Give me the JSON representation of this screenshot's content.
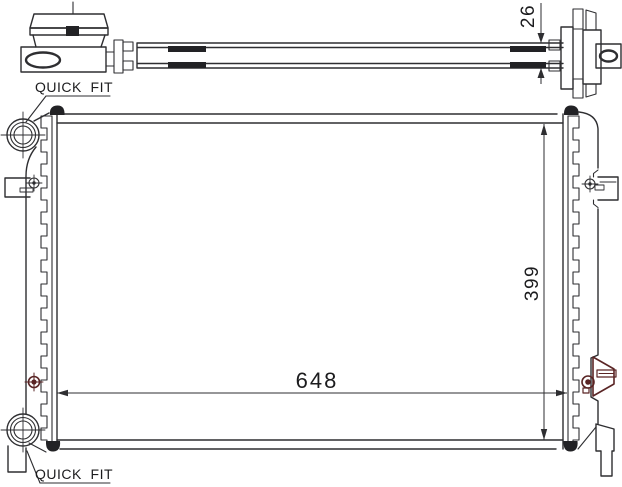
{
  "labels": {
    "quick_fit_top": "QUICK  FIT",
    "quick_fit_bottom": "QUICK  FIT"
  },
  "dimensions": {
    "core_width": "648",
    "core_height": "399",
    "core_depth": "26"
  },
  "colors": {
    "line": "#2e2e31",
    "accent_maroon": "#5a2525",
    "dim_width_text": "#46262a",
    "dim_text": "#38343a",
    "background": "#ffffff"
  }
}
